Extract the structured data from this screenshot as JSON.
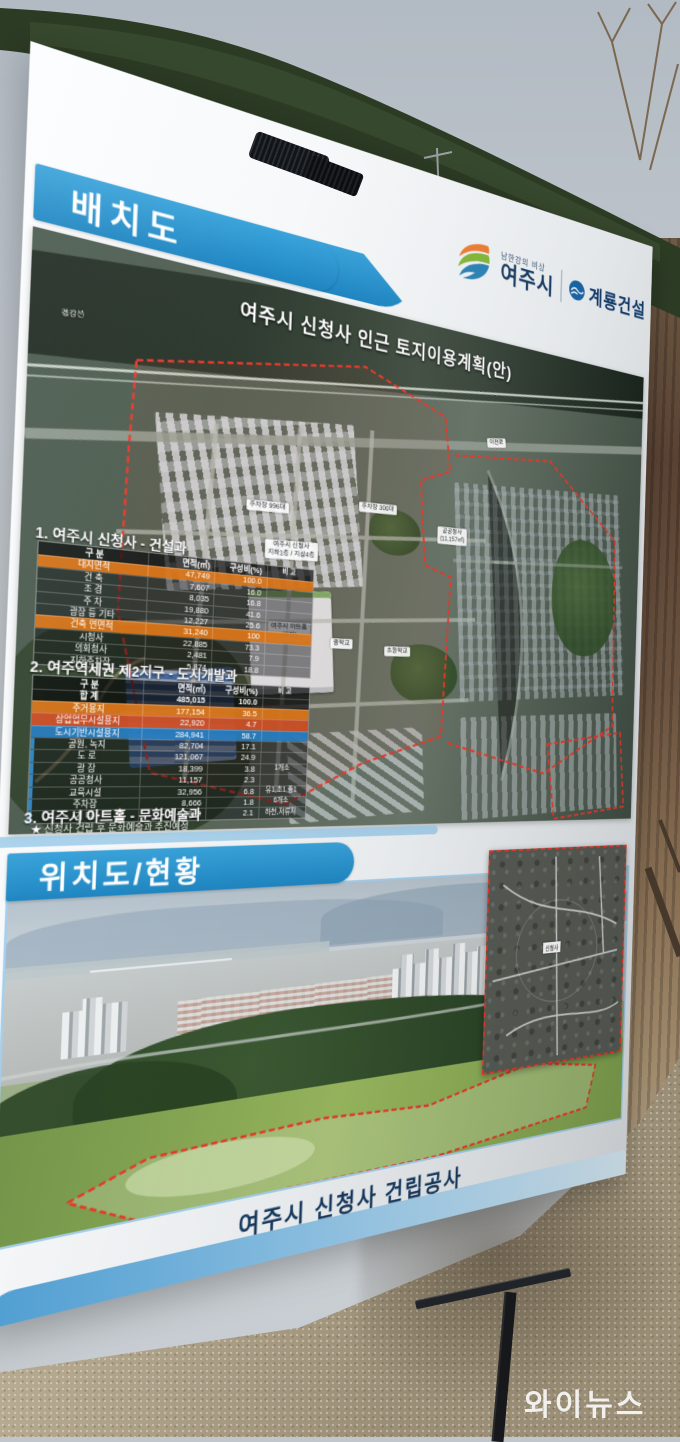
{
  "photo": {
    "watermark": "와이뉴스"
  },
  "board": {
    "banner1": "배치도",
    "banner2": "위치도/현황",
    "logos": {
      "tagline": "남한강의 비상",
      "city": "여주시",
      "builder": "계룡건설"
    },
    "map1": {
      "title": "여주시 신청사 인근 토지이용계획(안)",
      "labels": {
        "rail": "경강선",
        "road": "이천로",
        "cityhall_1": "여주시 신청사",
        "cityhall_2": "지하1층 / 지상4층",
        "parking_a": "주차장 996대",
        "parking_b": "주차장 300대",
        "office_1": "공공청사",
        "office_2": "(11,157㎡)",
        "arthall_1": "여주시 아트홀",
        "arthall_2": "(예정)",
        "school_mid": "중학교",
        "school_elem": "초등학교"
      }
    },
    "table1": {
      "title": "1. 여주시 신청사 - 건설과",
      "headers": [
        "구 분",
        "면적(㎡)",
        "구성비(%)",
        "비 고"
      ],
      "rows": [
        {
          "label": "대지면적",
          "area": "47,749",
          "ratio": "100.0",
          "note": ""
        },
        {
          "label": "건 축",
          "area": "7,607",
          "ratio": "16.0",
          "note": ""
        },
        {
          "label": "조 경",
          "area": "8,035",
          "ratio": "16.8",
          "note": ""
        },
        {
          "label": "주 차",
          "area": "19,880",
          "ratio": "41.6",
          "note": ""
        },
        {
          "label": "광장 등 기타",
          "area": "12,227",
          "ratio": "25.6",
          "note": ""
        },
        {
          "label": "건축 연면적",
          "area": "31,240",
          "ratio": "100",
          "note": ""
        },
        {
          "label": "시청사",
          "area": "22,885",
          "ratio": "73.3",
          "note": ""
        },
        {
          "label": "의회청사",
          "area": "2,481",
          "ratio": "7.9",
          "note": ""
        },
        {
          "label": "지하주차장",
          "area": "5,874",
          "ratio": "18.8",
          "note": ""
        }
      ]
    },
    "table2": {
      "title": "2. 여주역세권 제2지구 - 도시개발과",
      "headers": [
        "구 분",
        "면적(㎡)",
        "구성비(%)",
        "비 고"
      ],
      "rows": [
        {
          "label": "합 계",
          "area": "485,015",
          "ratio": "100.0",
          "note": ""
        },
        {
          "label": "주거용지",
          "area": "177,154",
          "ratio": "36.5",
          "note": ""
        },
        {
          "label": "상업업무시설용지",
          "area": "22,920",
          "ratio": "4.7",
          "note": ""
        },
        {
          "label": "도시기반시설용지",
          "area": "284,941",
          "ratio": "58.7",
          "note": ""
        },
        {
          "label": "공원, 녹지",
          "area": "82,704",
          "ratio": "17.1",
          "note": ""
        },
        {
          "label": "도 로",
          "area": "121,067",
          "ratio": "24.9",
          "note": ""
        },
        {
          "label": "광 장",
          "area": "18,399",
          "ratio": "3.8",
          "note": "1개소"
        },
        {
          "label": "공공청사",
          "area": "11,157",
          "ratio": "2.3",
          "note": ""
        },
        {
          "label": "교육시설",
          "area": "32,956",
          "ratio": "6.8",
          "note": "유1,초1,중1"
        },
        {
          "label": "주차장",
          "area": "8,666",
          "ratio": "1.8",
          "note": "6개소"
        },
        {
          "label": "기 타",
          "area": "9,992",
          "ratio": "2.1",
          "note": "하천,저류지"
        }
      ]
    },
    "section3": {
      "title": "3. 여주시 아트홀 - 문화예술과",
      "note": "★ 신청사 건립 후 문화예술과 추진예정"
    },
    "map2": {
      "inset_label": "신청사"
    },
    "caption": "여주시 신청사 건립공사"
  },
  "colors": {
    "banner_blue": "#2492cf",
    "accent_orange": "#e0781a",
    "accent_red": "#d55328",
    "accent_blue": "#2980c5",
    "boundary_red": "#e8392a"
  }
}
